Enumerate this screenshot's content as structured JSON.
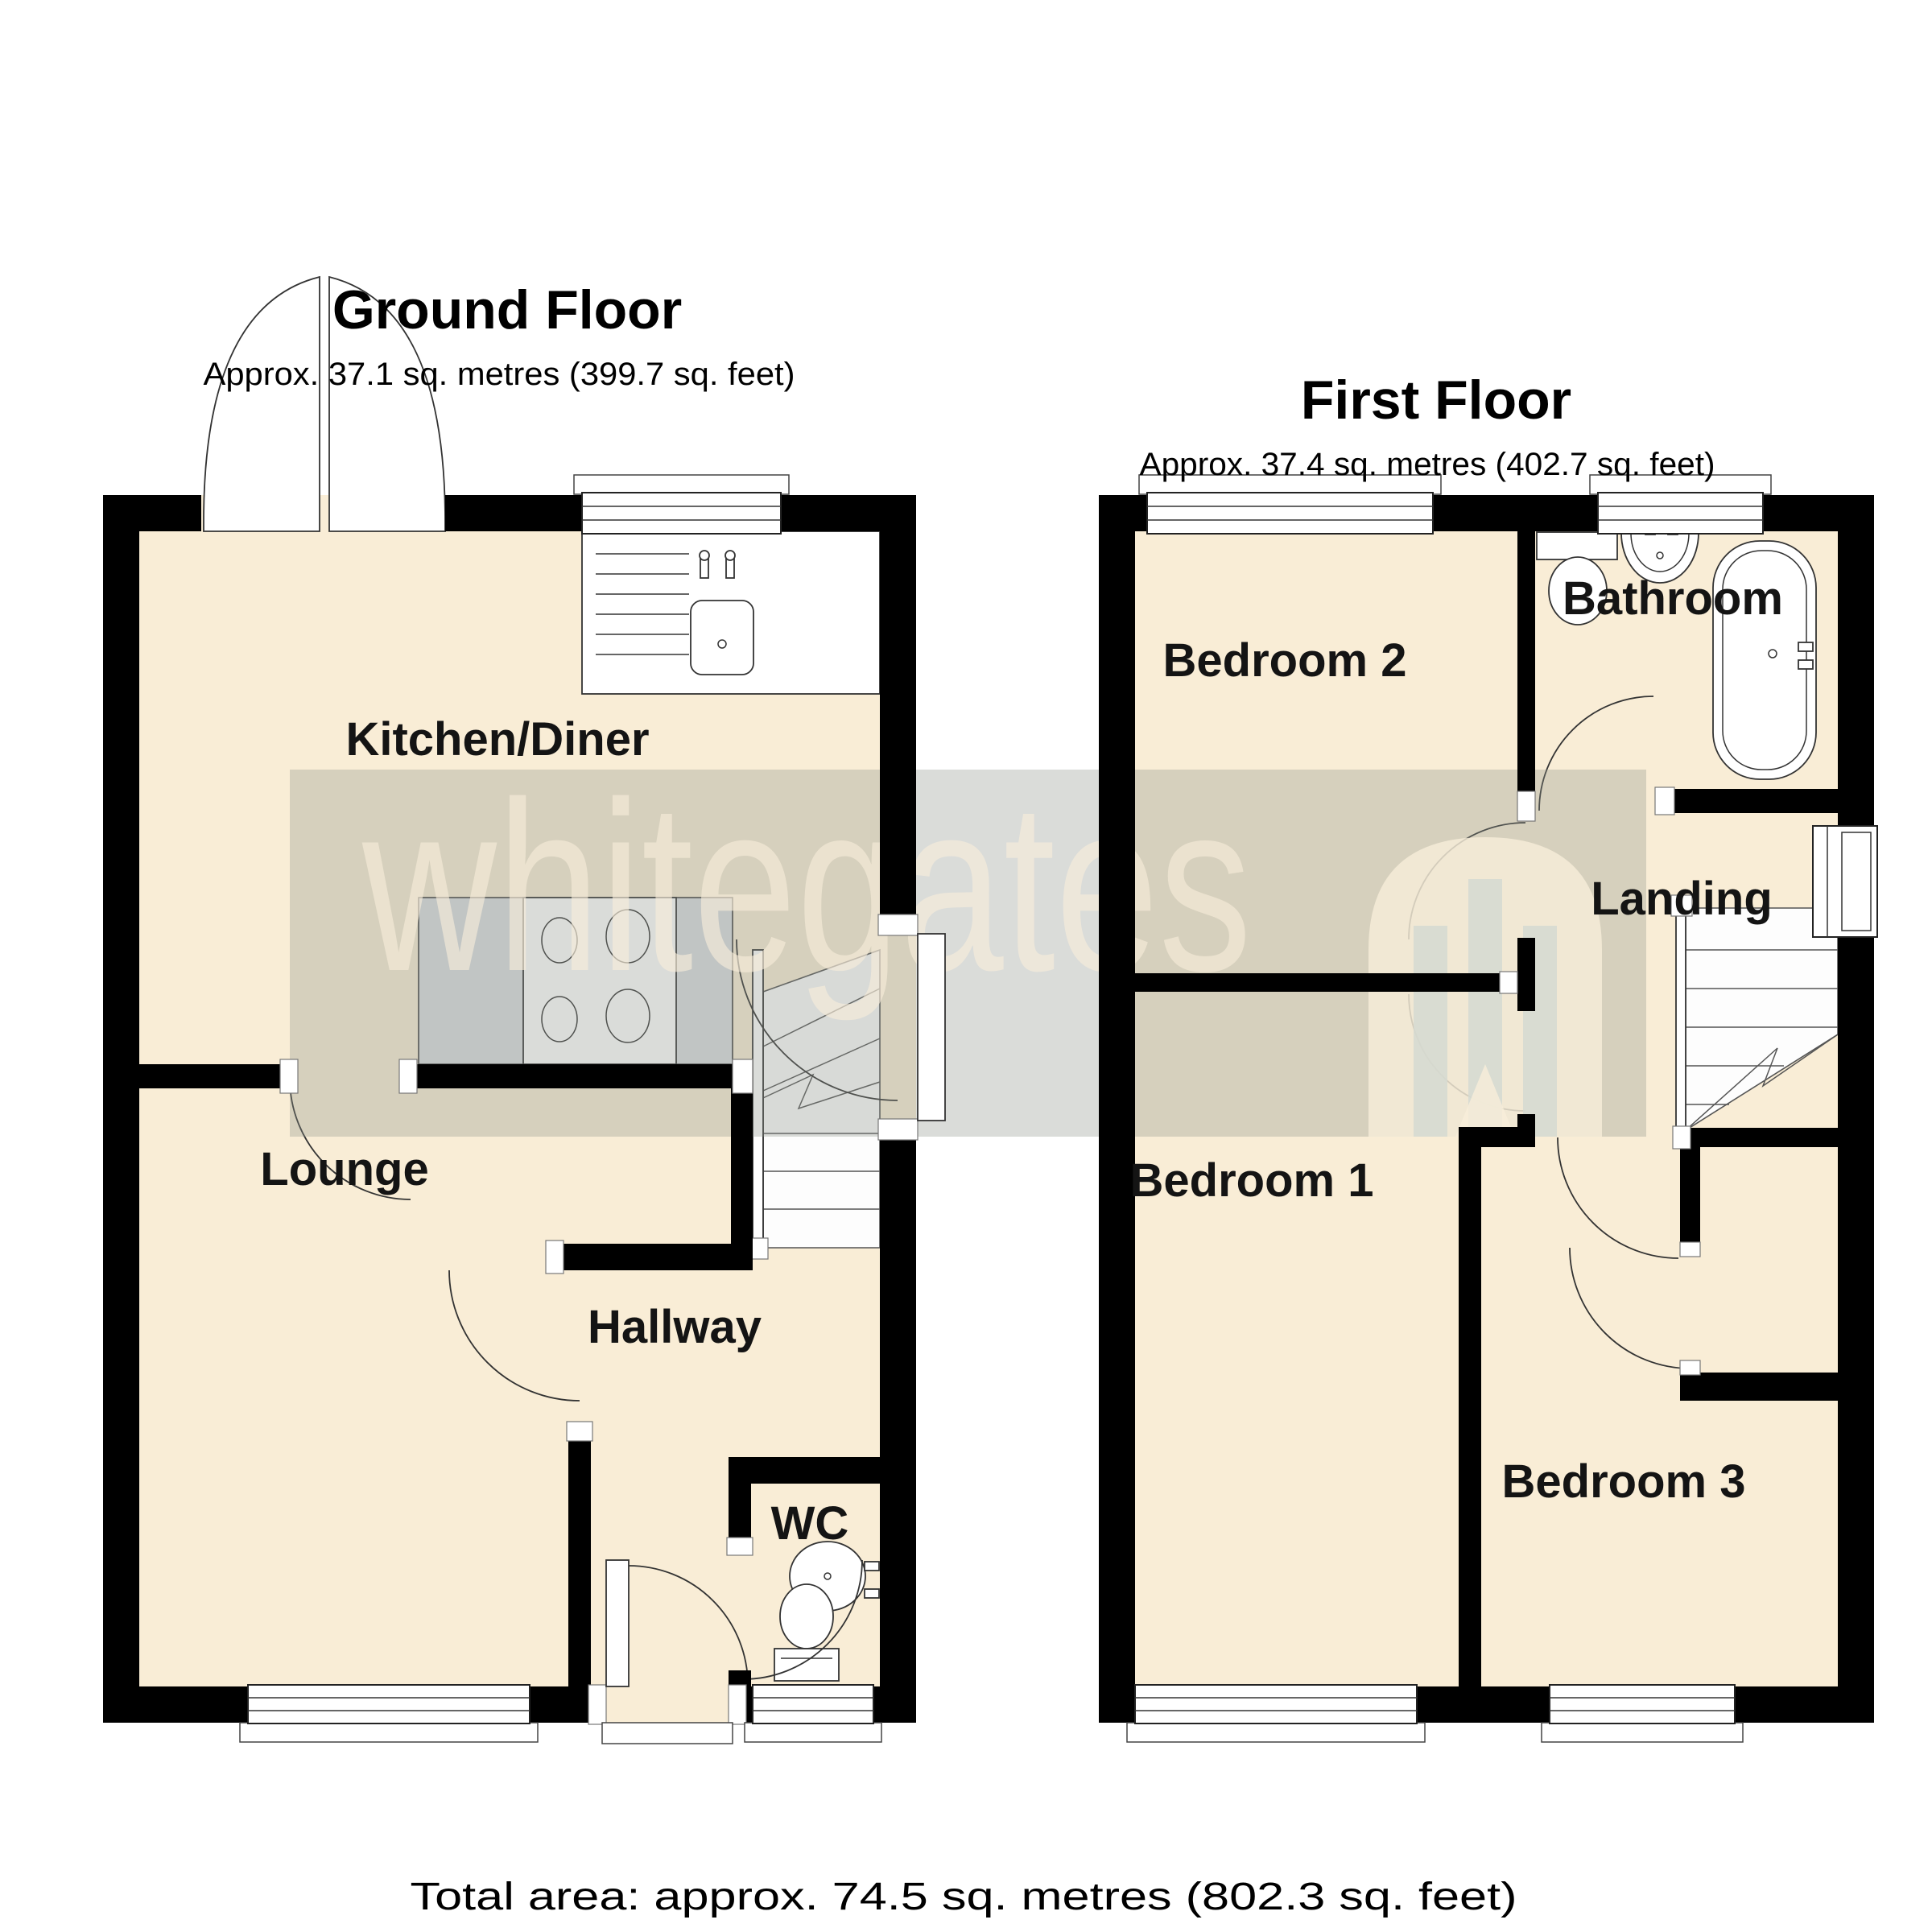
{
  "document": {
    "kind": "estate-agent-floorplan"
  },
  "ground_floor": {
    "title": "Ground Floor",
    "area_label": "Approx. 37.1 sq. metres (399.7 sq. feet)",
    "rooms": [
      {
        "name": "Kitchen/Diner"
      },
      {
        "name": "Lounge"
      },
      {
        "name": "Hallway"
      },
      {
        "name": "WC"
      }
    ],
    "features": [
      "french-doors",
      "sink-unit",
      "hob",
      "stairs-up",
      "back-door",
      "front-door",
      "wc-sink",
      "wc-toilet"
    ]
  },
  "first_floor": {
    "title": "First Floor",
    "area_label": "Approx. 37.4 sq. metres (402.7 sq. feet)",
    "rooms": [
      {
        "name": "Bedroom 2"
      },
      {
        "name": "Bathroom"
      },
      {
        "name": "Landing"
      },
      {
        "name": "Bedroom 1"
      },
      {
        "name": "Bedroom 3"
      }
    ],
    "features": [
      "bath",
      "bathroom-sink",
      "bathroom-toilet",
      "stairs-down",
      "airing-cupboard",
      "landing-window"
    ]
  },
  "footer": {
    "total_area_label": "Total area: approx. 74.5 sq. metres (802.3 sq. feet)"
  },
  "watermark": {
    "brand": "whitegates"
  },
  "colors": {
    "floor": "#f9edd6",
    "wall": "#000000",
    "counter": "#dadde1",
    "watermark_band": "#8c928a",
    "watermark_cream": "#f8eeda"
  }
}
